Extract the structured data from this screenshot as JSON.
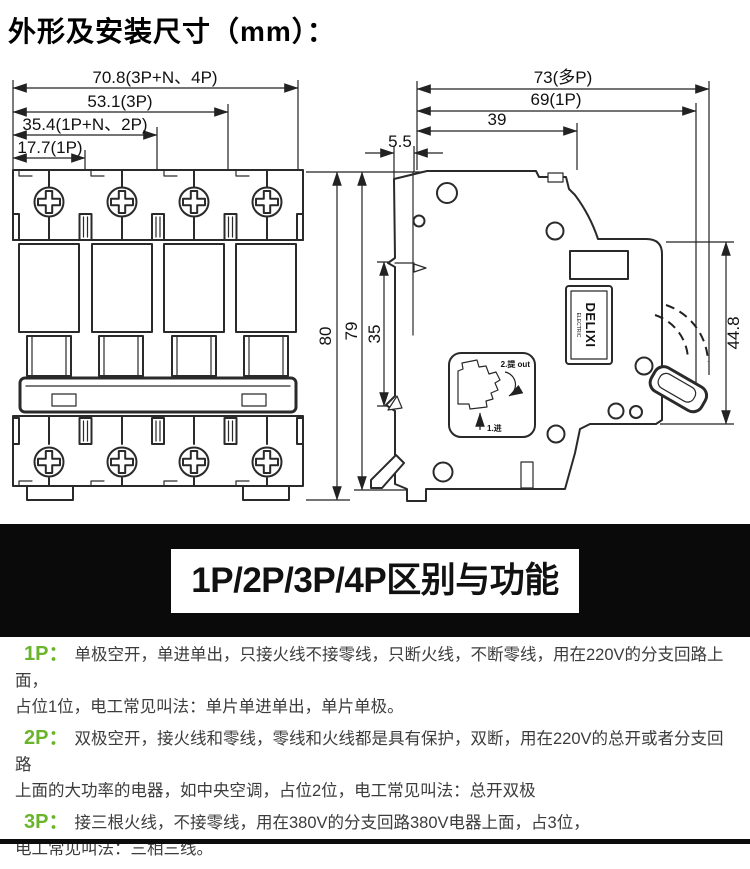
{
  "page": {
    "title": "外形及安装尺寸（mm）："
  },
  "drawing": {
    "front_view": {
      "dims": {
        "w4p": "70.8(3P+N、4P)",
        "w3p": "53.1(3P)",
        "w2p": "35.4(1P+N、2P)",
        "w1p": "17.7(1P)",
        "height": "80"
      }
    },
    "side_view": {
      "dims": {
        "d_multi": "73(多P)",
        "d_1p": "69(1P)",
        "d_front": "39",
        "rail_offset": "5.5",
        "height": "79",
        "rail_slot": "35",
        "front_height": "44.8"
      },
      "brand": {
        "name": "DELIXI",
        "sub": "ELECTRIC"
      },
      "detail": {
        "step2": "2.提 out",
        "step1": "1.进"
      }
    }
  },
  "banner": {
    "title": "1P/2P/3P/4P区别与功能"
  },
  "sections": [
    {
      "label": "1P：",
      "text": "单极空开，单进单出，只接火线不接零线，只断火线，不断零线，用在220V的分支回路上面，\n占位1位，电工常见叫法：单片单进单出，单片单极。"
    },
    {
      "label": "2P：",
      "text": "双极空开，接火线和零线，零线和火线都是具有保护，双断，用在220V的总开或者分支回路\n上面的大功率的电器，如中央空调，占位2位，电工常见叫法：总开双极"
    },
    {
      "label": "3P：",
      "text": "接三根火线，不接零线，用在380V的分支回路380V电器上面，占3位，\n电工常见叫法：三相三线。"
    },
    {
      "label": "4P：",
      "text": "接三根火线，一根零，用在380V的线路上面，占位4位，电工常见叫法：三相四线。"
    }
  ],
  "colors": {
    "accent_green": "#6ab42c",
    "banner_bg": "#0a0a0a",
    "line": "#2a2a2a"
  }
}
